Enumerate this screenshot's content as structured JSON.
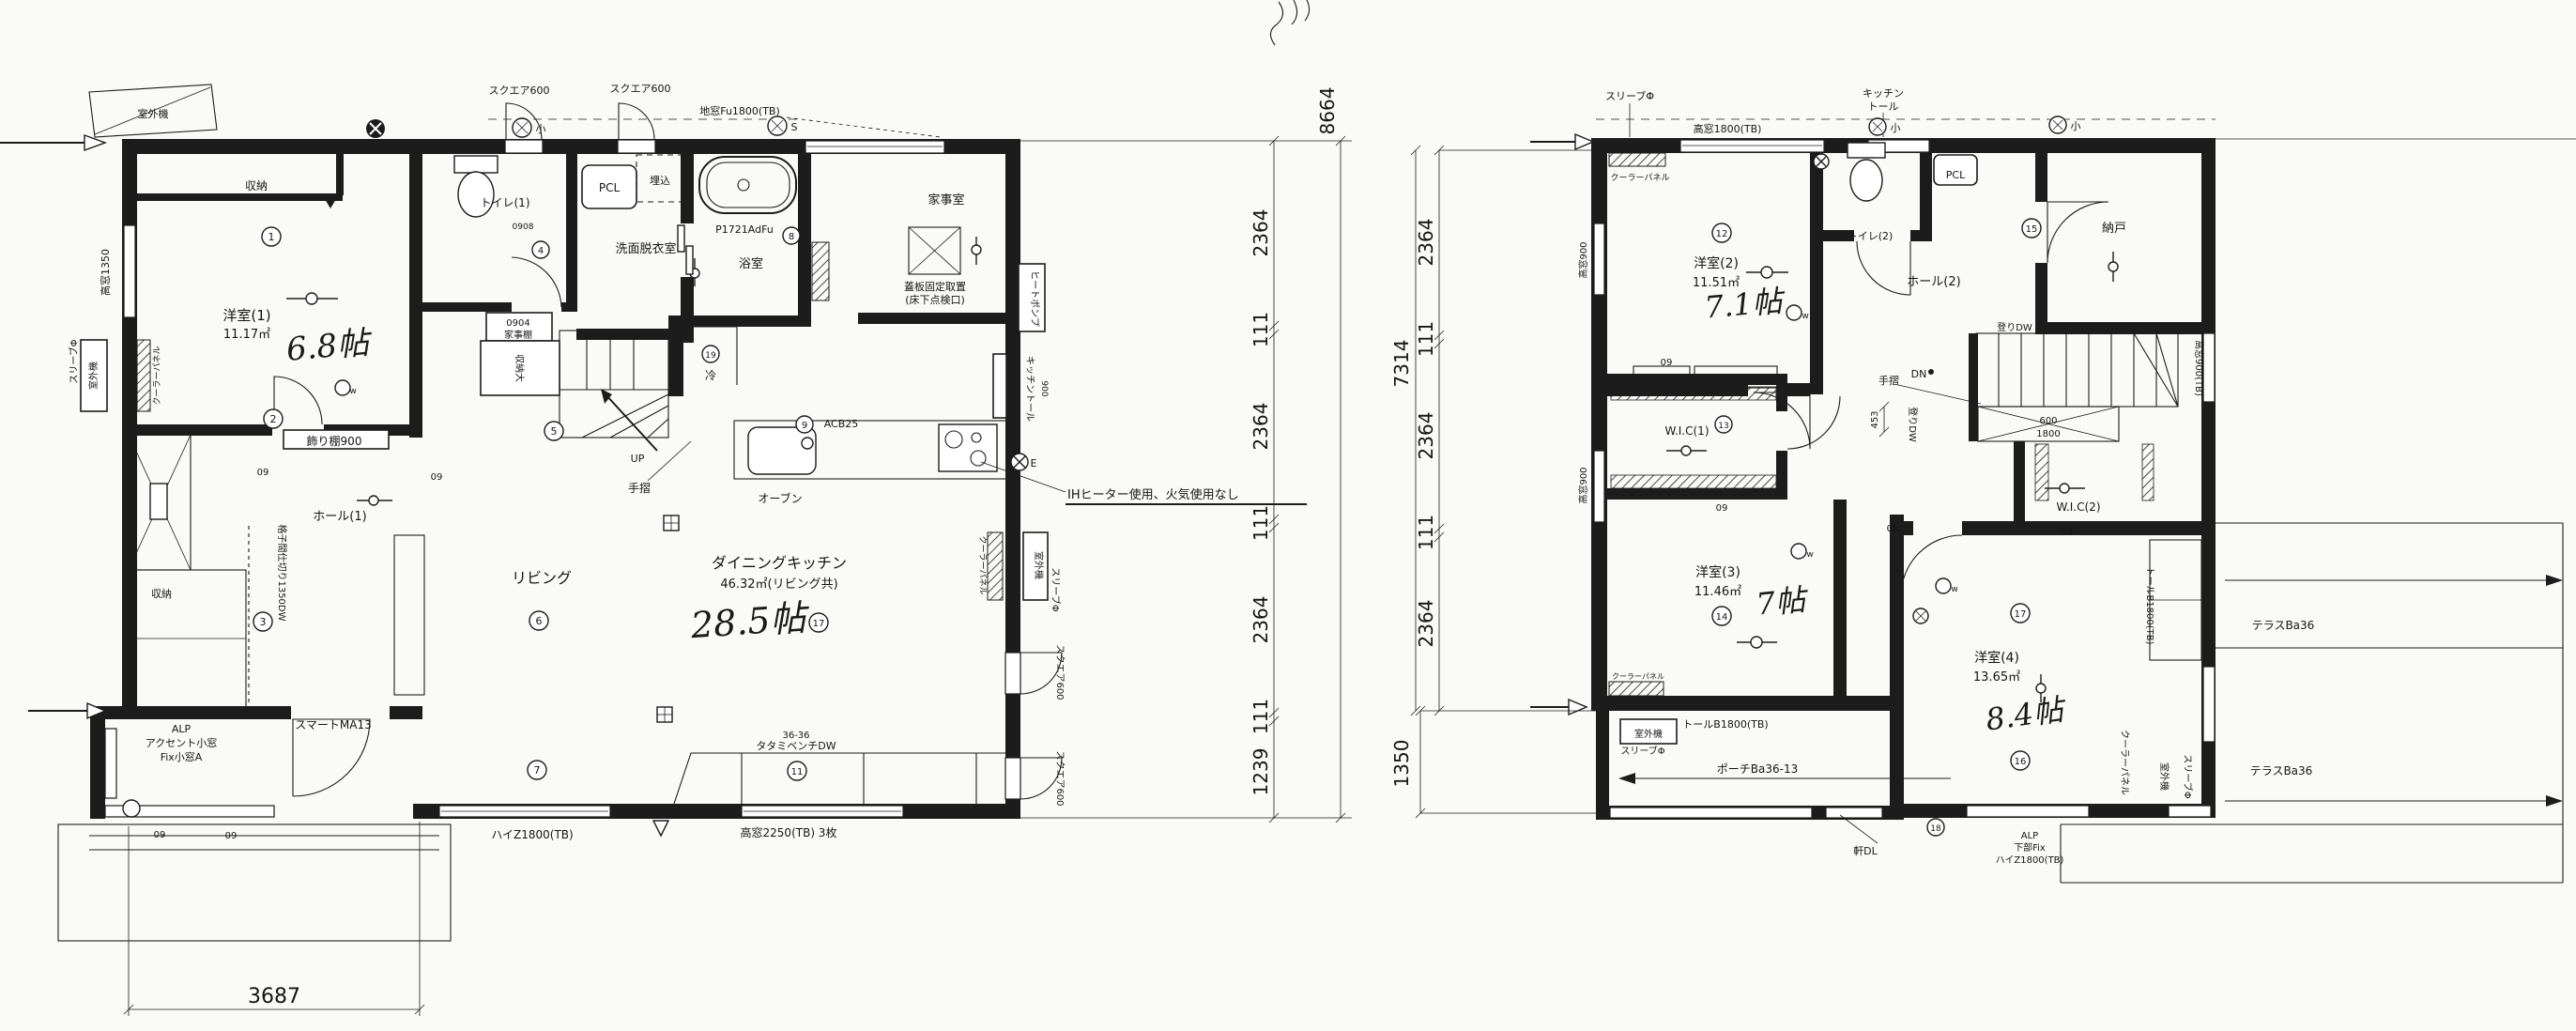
{
  "f1": {
    "rooms": {
      "r1_name": "洋室(1)",
      "r1_area": "11.17㎡",
      "r1_jo": "6.8帖",
      "toilet": "トイレ(1)",
      "senmen": "洗面脱衣室",
      "bath": "浴室",
      "kaji": "家事室",
      "hall": "ホール(1)",
      "living": "リビング",
      "dk": "ダイニングキッチン",
      "dk_area": "46.32㎡(リビング共)",
      "dk_jo": "28.5帖"
    },
    "fixtures": {
      "shuno": "収納",
      "shuno_dai": "収納大",
      "kazaridana": "飾り棚900",
      "koshi": "格子間仕切り1350DW",
      "pcl": "PCL",
      "umekomi": "埋込",
      "bath_model": "P1721AdFu",
      "tenkenko1": "蓋板固定取置",
      "tenkenko2": "(床下点検口)",
      "t0904": "0904",
      "kajidana": "家事棚",
      "tesuri": "手摺",
      "oven": "オーブン",
      "rei": "冷",
      "acb": "ACB25",
      "heatpump": "ヒートポンプ",
      "ktall": "キッチントール",
      "ktall_w": "900",
      "bench1": "36-36",
      "bench2": "タタミベンチDW",
      "door": "スマートMA13",
      "alp": "ALP",
      "alp2": "アクセント小窓",
      "alp3": "Fix小窓A",
      "d0908": "0908"
    },
    "windows": {
      "sq600": "スクエア600",
      "jimado": "地窓Fu1800(TB)",
      "t1350": "高窓1350",
      "haiz": "ハイZ1800(TB)",
      "t2250": "高窓2250(TB) 3枚"
    },
    "notes": {
      "ih": "IHヒーター使用、火気使用なし",
      "up": "UP"
    }
  },
  "f2": {
    "rooms": {
      "r2_name": "洋室(2)",
      "r2_area": "11.51㎡",
      "r2_jo": "7.1帖",
      "r3_name": "洋室(3)",
      "r3_area": "11.46㎡",
      "r3_jo": "7帖",
      "r4_name": "洋室(4)",
      "r4_area": "13.65㎡",
      "r4_jo": "8.4帖",
      "wic1": "W.I.C(1)",
      "wic2": "W.I.C(2)",
      "nando": "納戸",
      "hall": "ホール(2)",
      "toilet": "トイレ(2)"
    },
    "fixtures": {
      "pcl": "PCL",
      "dn": "DN",
      "tesuri": "手摺",
      "nobori": "登りDW",
      "void_w": "600",
      "void_l": "1800",
      "tall": "トールB1800(TB)",
      "porch": "ポーチBa36-13",
      "noki": "軒DL",
      "terrace": "テラスBa36",
      "alp": "ALP",
      "alp2": "下部Fix",
      "alp3": "ハイZ1800(TB)",
      "ktall1": "キッチン",
      "ktall2": "トール"
    },
    "windows": {
      "t1800": "高窓1800(TB)",
      "t900": "高窓900",
      "t900tb": "高窓900(TB)"
    }
  },
  "site": {
    "sleeve": "スリーブΦ",
    "outdoor": "室外機",
    "cooler": "クーラーパネル",
    "mod09": "09"
  },
  "dims": {
    "d2364": "2364",
    "d111": "111",
    "d1239": "1239",
    "t8664": "8664",
    "w3687": "3687",
    "t7314": "7314",
    "d1350": "1350",
    "d453": "453"
  },
  "marks": {
    "n1": "1",
    "n2": "2",
    "n3": "3",
    "n4": "4",
    "n5": "5",
    "n6": "6",
    "n7": "7",
    "n8": "8",
    "n9": "9",
    "n11": "11",
    "n12": "12",
    "n13": "13",
    "n14": "14",
    "n15": "15",
    "n16": "16",
    "n17": "17",
    "n18": "18",
    "n19": "19",
    "ko": "小",
    "s": "S",
    "e": "E",
    "w": "w"
  }
}
